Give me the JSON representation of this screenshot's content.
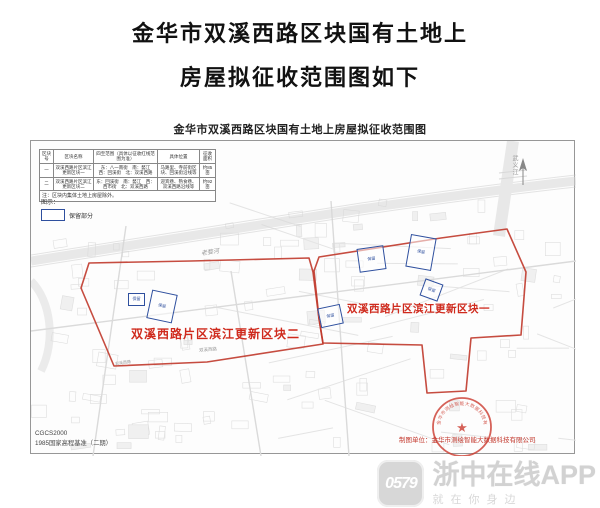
{
  "page": {
    "title_line1": "金华市双溪西路区块国有土地上",
    "title_line2": "房屋拟征收范围图如下"
  },
  "map": {
    "title": "金华市双溪西路区块国有土地上房屋拟征收范围图",
    "table": {
      "headers": [
        "区块号",
        "区块名称",
        "四至范围（具体以征收红线范围为准）",
        "具体位置",
        "征收面积"
      ],
      "rows": [
        [
          "一",
          "双溪西路片区滨江更新区块一",
          "东：八一南街　南：婺江　西：回溪街　北：双溪西路",
          "马路里、寺前街区块、回溪街沿线等",
          "约85亩"
        ],
        [
          "二",
          "双溪西路片区滨江更新区块二",
          "东：回溪街　南：婺江　西：西市街　北：双溪西路",
          "迎宾巷、熟食巷、双溪西路沿线等",
          "约92亩"
        ]
      ],
      "note": "注：区块内集体土地上房屋除外。"
    },
    "legend": {
      "label": "图示：",
      "item_label": "保留部分"
    },
    "labels": {
      "block1": "双溪西路片区滨江更新区块一",
      "block2": "双溪西路片区滨江更新区块二",
      "river1": "老婺河",
      "river2": "武义江",
      "road1": "双溪西路",
      "road2": "双溪西路"
    },
    "retained_areas": [
      "保留",
      "保留",
      "保留",
      "保留",
      "保留",
      "保留"
    ],
    "datum_line1": "CGCS2000",
    "datum_line2": "1985国家高程基准（二期）",
    "credit": "制图单位：金华市测绘智能大数据科技有限公司",
    "seal_text": "金华市测绘智能大数据科技有限公司",
    "colors": {
      "boundary_red": "#c0392b",
      "retained_blue": "#2e4f9e",
      "label_red": "#cf2a1d"
    }
  },
  "watermark": {
    "badge": "0579",
    "title": "浙中在线APP",
    "subtitle": "就在你身边"
  }
}
